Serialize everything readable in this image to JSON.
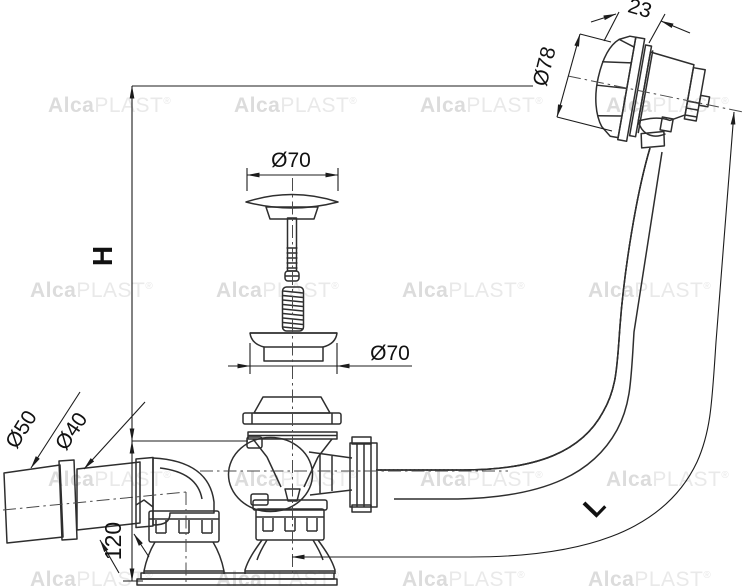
{
  "drawing": {
    "kind": "technical line drawing of a bath waste, overflow and trap set, side view with exploded plug parts"
  },
  "dimensions": {
    "height_label": "H",
    "hose_length_label": "L",
    "trap_height": "120",
    "knob_depth": "23",
    "knob_diameter": "Ø78",
    "plug_diameter": "Ø70",
    "seal_diameter": "Ø70",
    "sleeve_diameter": "Ø50",
    "pipe_diameter": "Ø40"
  },
  "watermark": {
    "alca": "Alca",
    "plast": "PLAST",
    "registered": "®"
  },
  "colors": {
    "line": "#2e2e2e",
    "dimension": "#1c1c1c",
    "centerline": "#4a4a4a",
    "watermark_bold": "#dcdcdc",
    "watermark_light": "#e9e9e9",
    "background": "#ffffff",
    "text": "#111111"
  }
}
